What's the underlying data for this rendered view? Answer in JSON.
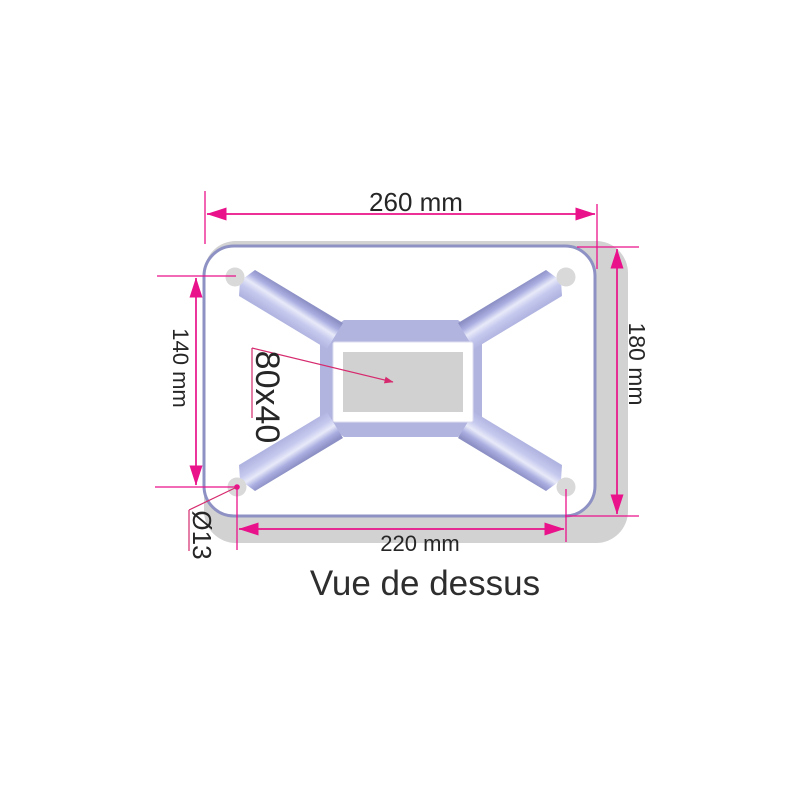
{
  "drawing": {
    "title": "Vue de dessus",
    "dimensions": {
      "overall_width": "260 mm",
      "overall_height": "180 mm",
      "hole_spacing_vertical": "140 mm",
      "hole_spacing_horizontal": "220 mm",
      "tube_section": "80x40",
      "hole_diameter": "Ø13"
    },
    "colors": {
      "dimension_magenta": "#e9128a",
      "leader_red": "#d62a6e",
      "plate_outline_purple": "#8e91c3",
      "plate_side_gray": "#d2d2d2",
      "plate_face_white": "#ffffff",
      "rib_dark": "#8c90c4",
      "rib_light": "#e8eaf9",
      "center_plate_purple": "#b1b4de",
      "tube_hole_gray": "#d1d1d1",
      "corner_hole_gray": "#d9d9d9",
      "text_dark": "#262626"
    }
  }
}
